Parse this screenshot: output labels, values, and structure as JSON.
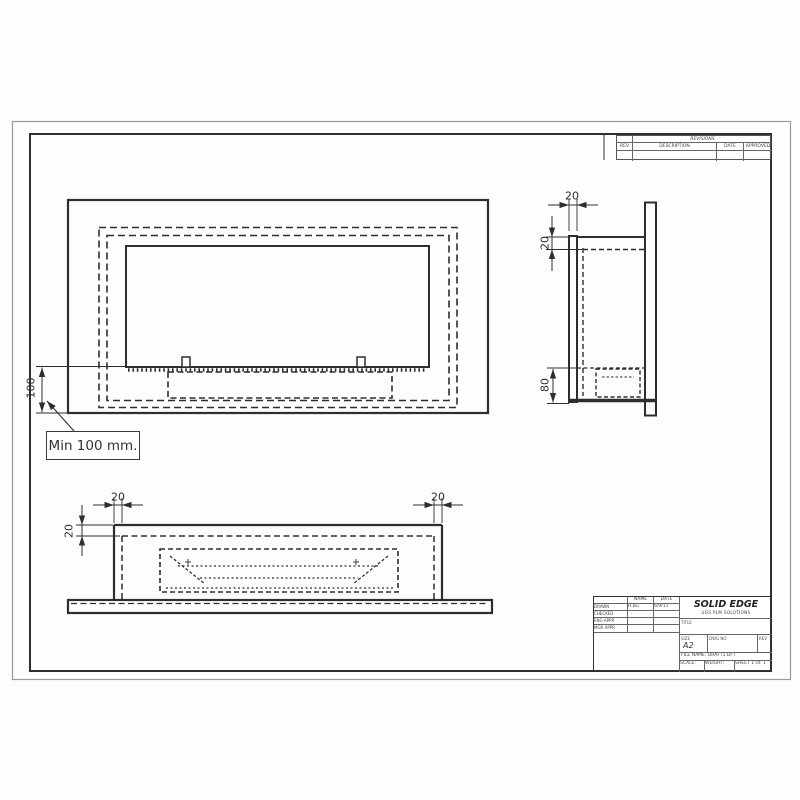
{
  "drawing": {
    "min_note": "Min 100 mm.",
    "front_height_dim": "100",
    "side_flange_dim": "20",
    "side_top_dim": "20",
    "side_burner_dim": "80",
    "bottom_left_width_dim": "20",
    "bottom_left_depth_dim": "20",
    "bottom_right_width_dim": "20"
  },
  "revisions": {
    "title": "REVISIONS",
    "col_rev": "REV",
    "col_description": "DESCRIPTION",
    "col_date": "DATE",
    "col_approved": "APPROVED"
  },
  "title_block": {
    "brand": "SOLID EDGE",
    "brand_sub": "UGS PLM SOLUTIONS",
    "col_name": "NAME",
    "col_date": "DATE",
    "rows": [
      {
        "label": "DRAWN",
        "name": "H.Bu",
        "date": "6/9/11"
      },
      {
        "label": "CHECKED",
        "name": "",
        "date": ""
      },
      {
        "label": "ENG APPR",
        "name": "",
        "date": ""
      },
      {
        "label": "MGR APPR",
        "name": "",
        "date": ""
      }
    ],
    "title_label": "TITLE",
    "size_label": "SIZE",
    "size_value": "A2",
    "dwg_label": "DWG NO",
    "rev_label": "REV",
    "file_label": "FILE NAME:",
    "file_value": "DRAFT1.DFT",
    "scale_label": "SCALE:",
    "weight_label": "WEIGHT:",
    "sheet_label": "SHEET 1 OF 1"
  },
  "colors": {
    "line": "#2e2e2e",
    "paper": "#ffffff"
  }
}
